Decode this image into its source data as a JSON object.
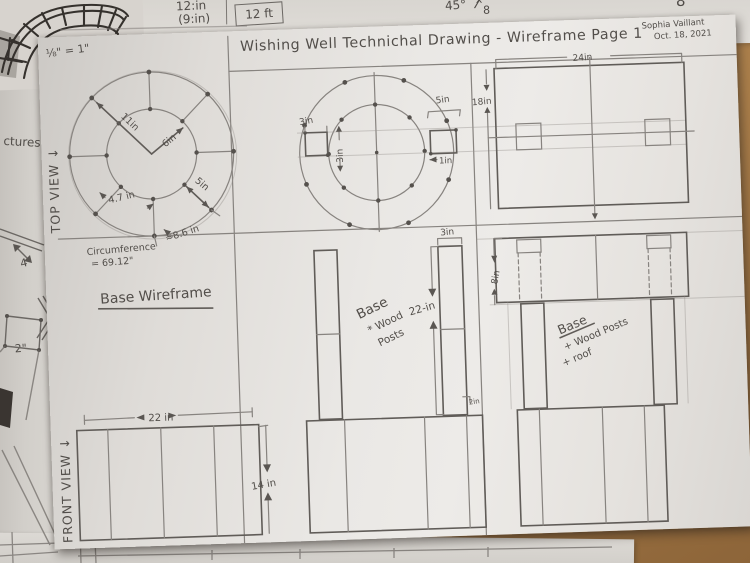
{
  "background": {
    "top_sheet": {
      "dim_top": "12:in",
      "dim_bottom": "(9:in)",
      "boxed_dim": "12 ft",
      "angle": "45°",
      "fraction_numerator": "x",
      "fraction_denominator": "8",
      "corner_number": "8"
    },
    "left_sheet": {
      "partial_word": "ctures:",
      "dim_a": "4\"",
      "dim_b": "2\""
    }
  },
  "sheet": {
    "scale_note": "⅛\" = 1\"",
    "title": "Wishing Well Technichal Drawing - Wireframe Page 1",
    "author": "Sophia Vaillant",
    "date": "Oct. 18, 2021",
    "top_view_label": "TOP VIEW ↓",
    "front_view_label": "FRONT VIEW ↓",
    "top_view": {
      "outer_radius": "11in",
      "inner_radius": "6in",
      "ring_gap": "5in",
      "inner_arc": "4.7 in",
      "outer_arc": "≈8.6 in",
      "circumference_line1": "Circumference",
      "circumference_line2": "= 69.12\"",
      "caption": "Base Wireframe"
    },
    "plan_view": {
      "post_width": "3in",
      "post_height": "3in",
      "ring_span": "5in",
      "post_inset": "1in"
    },
    "side_view": {
      "width": "24in",
      "height": "18in"
    },
    "posts_view": {
      "post_width": "3in",
      "post_height": "22-in",
      "detail_dim": "2in",
      "note": [
        "Base",
        "* Wood",
        "Posts"
      ]
    },
    "roof_view": {
      "roof_height": "8in",
      "note": [
        "Base",
        "+ Wood Posts",
        "+ roof"
      ]
    },
    "front_view": {
      "width": "22 in",
      "height": "14 in"
    }
  }
}
